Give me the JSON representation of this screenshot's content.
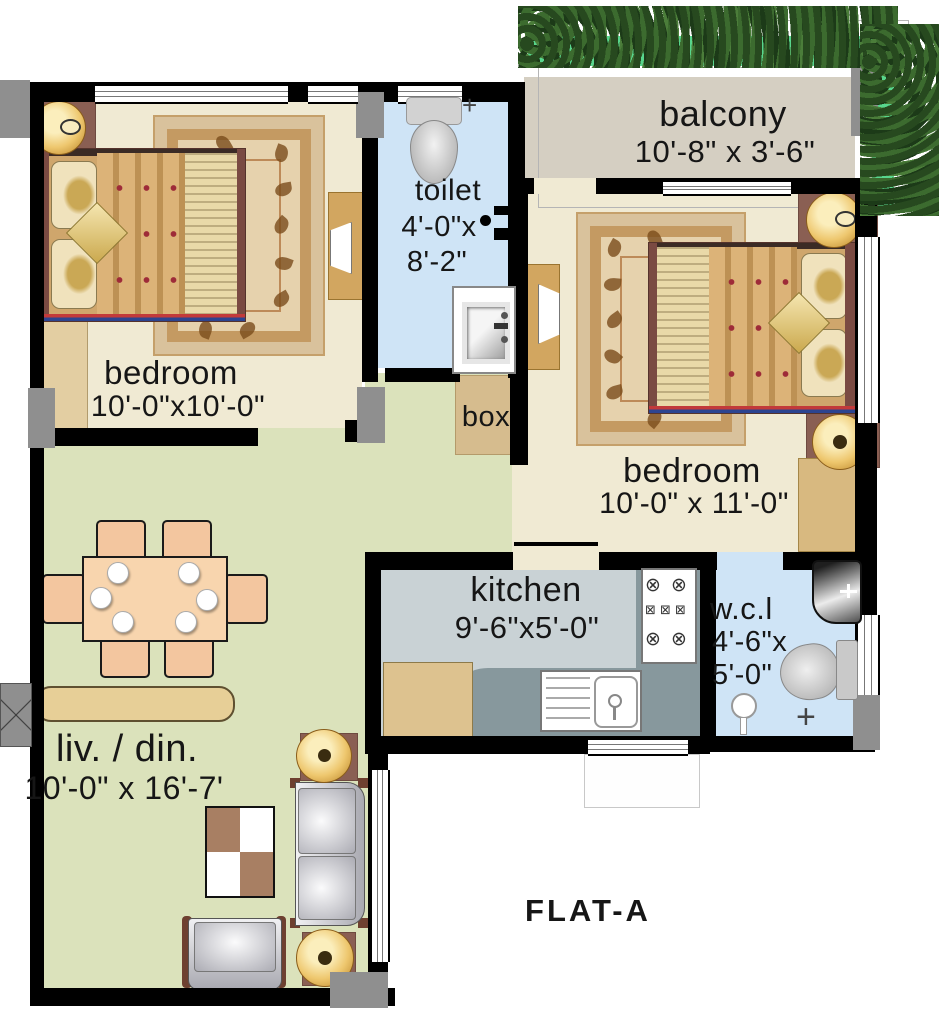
{
  "title": {
    "label": "FLAT-A"
  },
  "rooms": {
    "bedroom1": {
      "name": "bedroom",
      "dims": "10'-0\"x10'-0\""
    },
    "toilet": {
      "name": "toilet",
      "dims1": "4'-0\"x",
      "dims2": "8'-2\""
    },
    "balcony": {
      "name": "balcony",
      "dims": "10'-8\" x 3'-6\""
    },
    "bedroom2": {
      "name": "bedroom",
      "dims": "10'-0\" x 11'-0\""
    },
    "box": {
      "name": "box"
    },
    "kitchen": {
      "name": "kitchen",
      "dims": "9'-6\"x5'-0\""
    },
    "wc": {
      "name": "w.c.l",
      "dims1": "4'-6\"x",
      "dims2": "5'-0\""
    },
    "living": {
      "name": "liv. / din.",
      "dims": "10'-0\" x 16'-7'"
    }
  },
  "icons": {
    "burner": "⊗",
    "element": "⊠",
    "plus": "+"
  },
  "colors": {
    "wall": "#000000",
    "bedroom_floor": "#f0ead3",
    "living_floor": "#dbe2bb",
    "kitchen_floor": "#c9d2d5",
    "bath_floor": "#cfe4f6",
    "balcony_floor": "#d5cfc2",
    "counter_gray": "#87989d",
    "wood_tan": "#d9b177",
    "lamp_gold": "#eec76e",
    "hedge_green": "#58d68d"
  }
}
